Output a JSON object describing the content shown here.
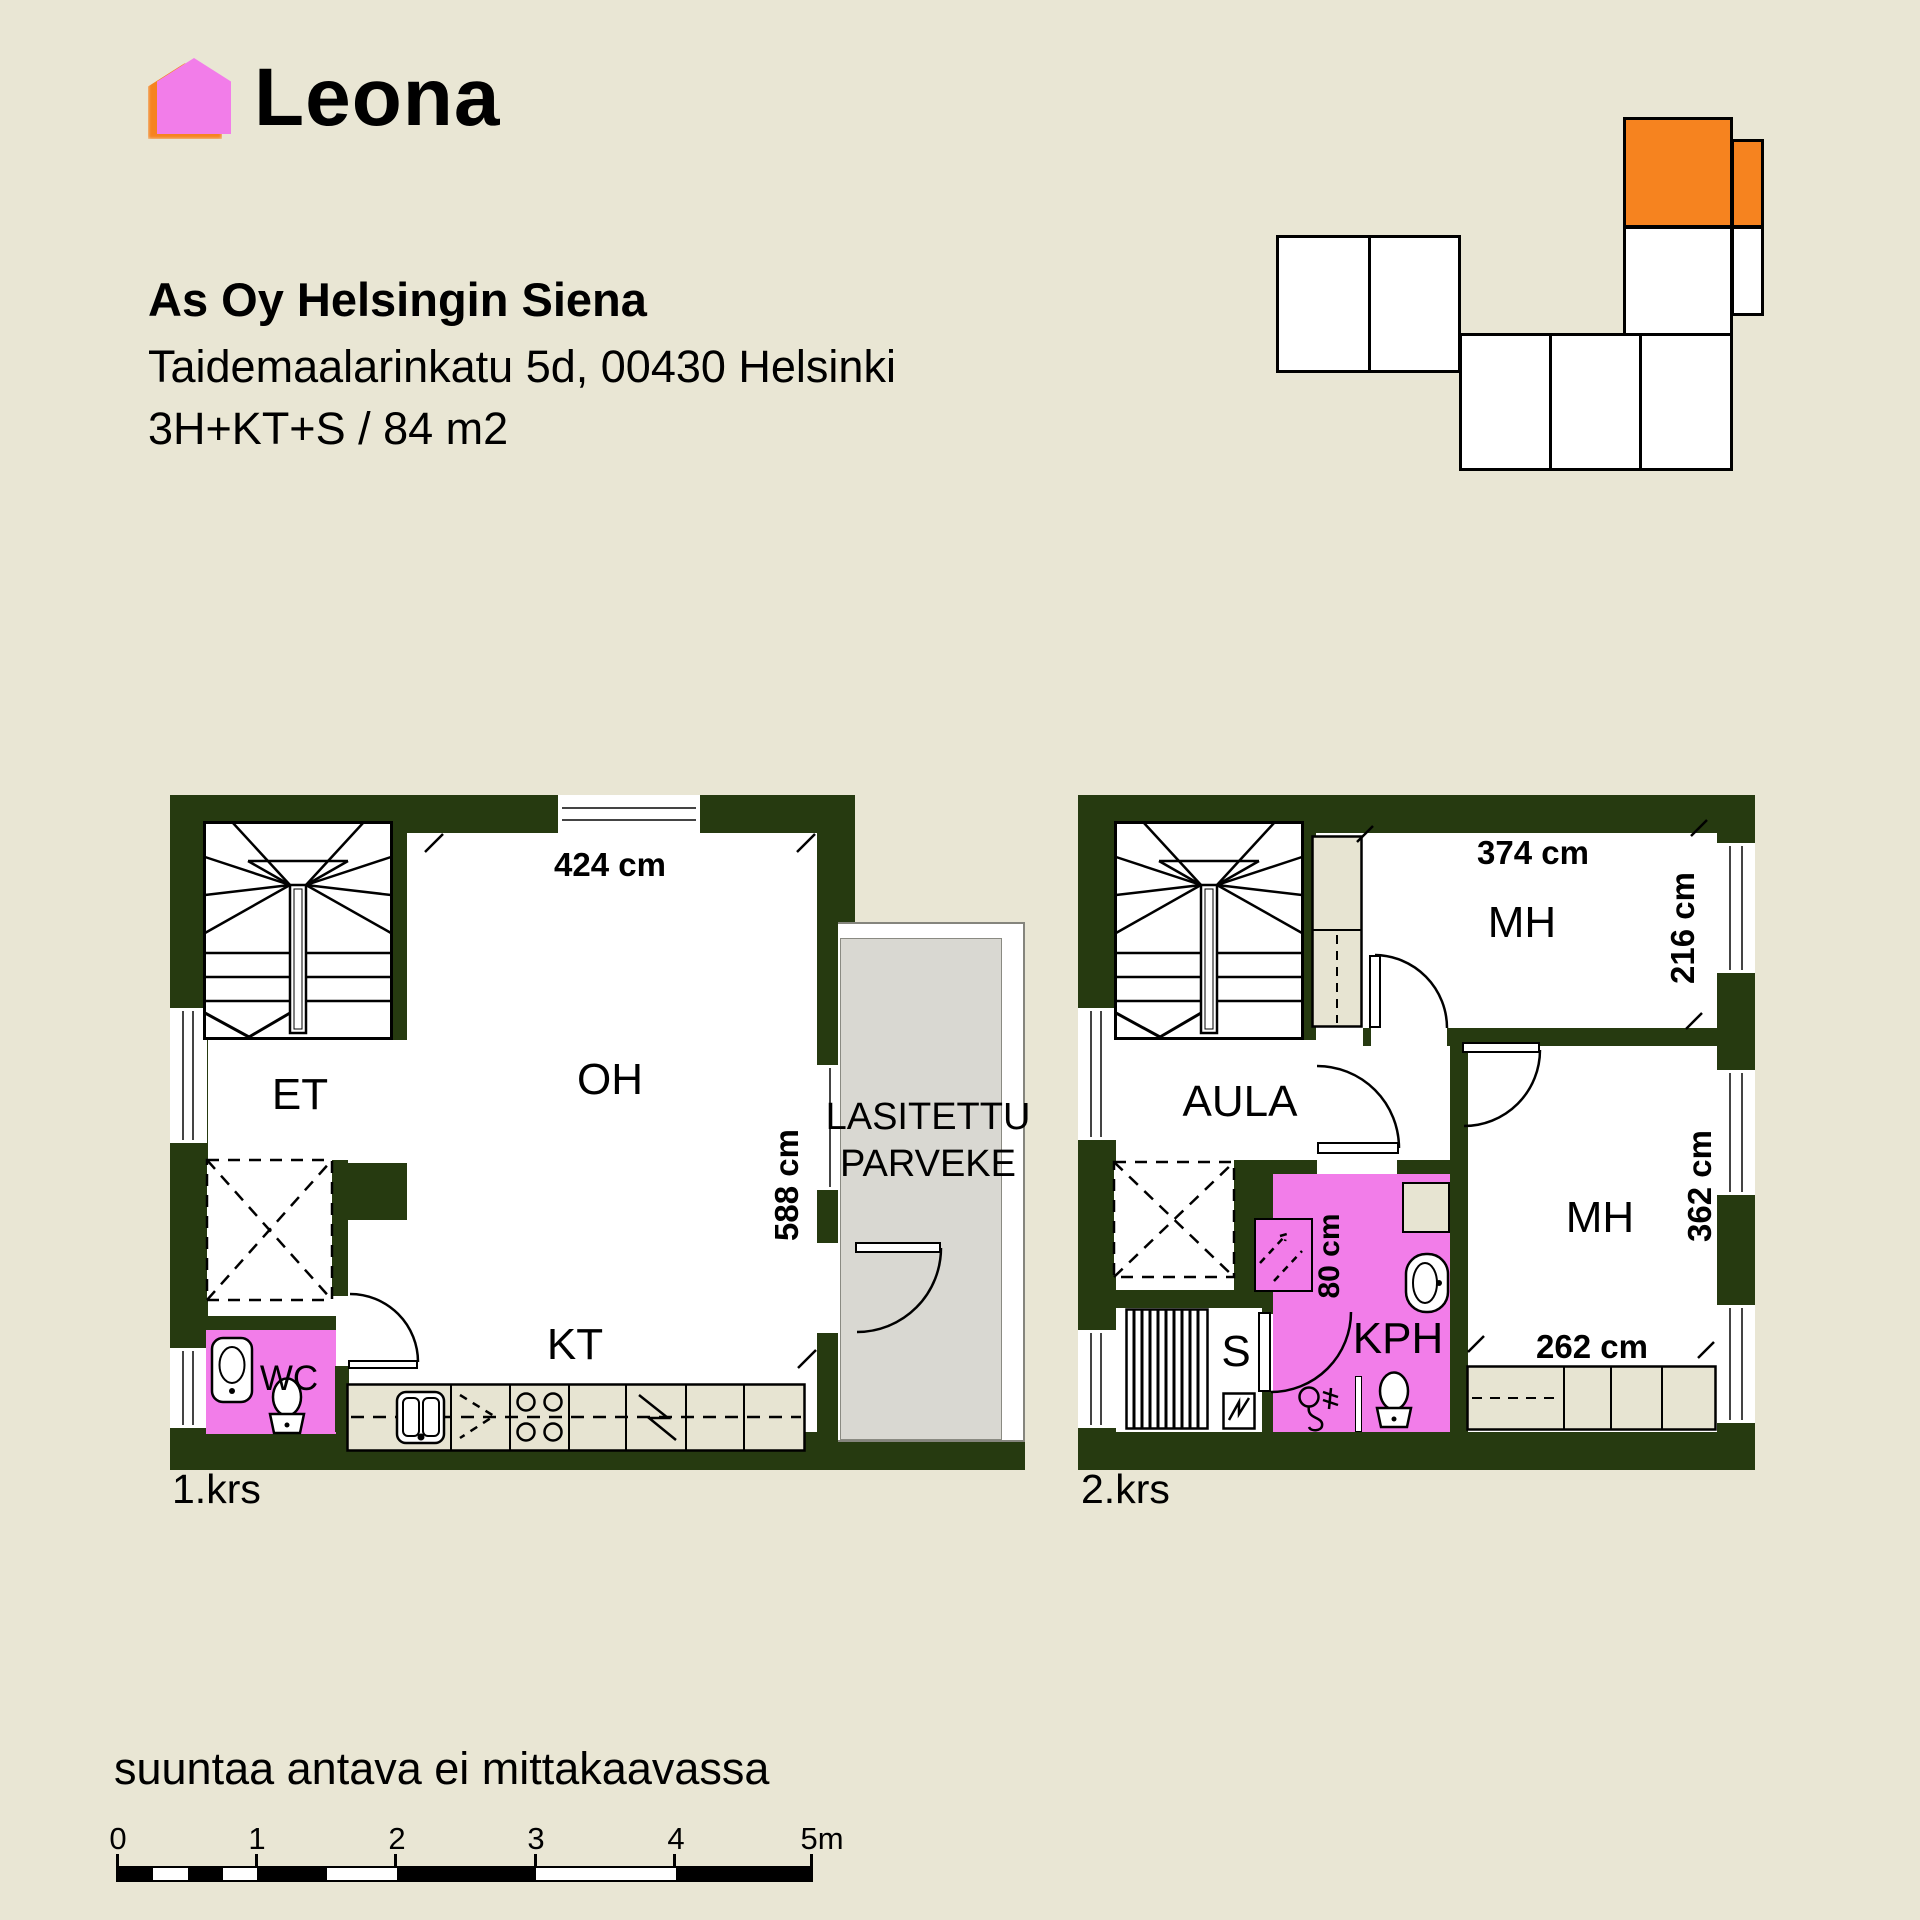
{
  "header": {
    "logo_text": "Leona",
    "project_name": "As Oy Helsingin Siena",
    "address_line": "Taidemaalarinkatu 5d, 00430 Helsinki",
    "spec_line": "3H+KT+S / 84 m2"
  },
  "floor1": {
    "label": "1.krs",
    "rooms": {
      "entry": "ET",
      "living": "OH",
      "kitchen": "KT",
      "wc": "WC"
    },
    "balcony_line1": "LASITETTU",
    "balcony_line2": "PARVEKE",
    "dims": {
      "top": "424 cm",
      "right": "588 cm"
    }
  },
  "floor2": {
    "label": "2.krs",
    "rooms": {
      "hall": "AULA",
      "bedroom_top": "MH",
      "bedroom_right": "MH",
      "sauna": "S",
      "bathroom": "KPH"
    },
    "dims": {
      "bed1_width": "374 cm",
      "bed1_depth": "216 cm",
      "bed2_height": "362 cm",
      "bed2_width": "262 cm",
      "shower": "80 cm"
    }
  },
  "footer": {
    "disclaimer": "suuntaa antava ei mittakaavassa",
    "scale_labels": [
      "0",
      "1",
      "2",
      "3",
      "4",
      "5m"
    ]
  },
  "colors": {
    "background": "#e9e6d4",
    "wall": "#263a10",
    "wet_room": "#f27de9",
    "accent_orange": "#f6831f",
    "balcony_gray": "#d9d8d2",
    "cabinet_beige": "#e7e4d2"
  }
}
